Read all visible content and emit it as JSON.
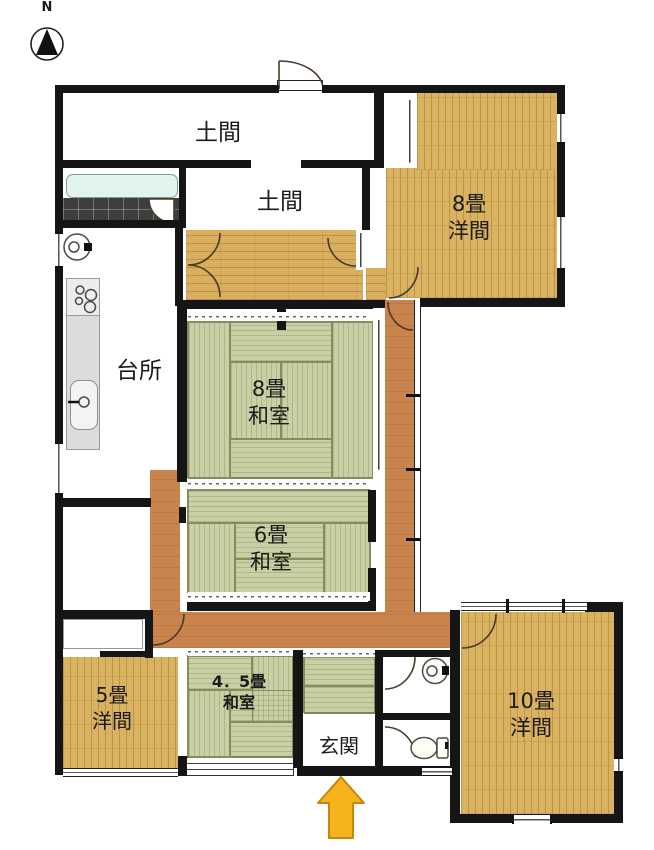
{
  "compass": {
    "label": "N"
  },
  "rooms": {
    "doma_upper": {
      "label": "土間"
    },
    "doma_lower": {
      "label": "土間"
    },
    "kitchen": {
      "label": "台所"
    },
    "western8": {
      "size": "8畳",
      "type": "洋間"
    },
    "japanese8": {
      "size": "8畳",
      "type": "和室"
    },
    "japanese6": {
      "size": "6畳",
      "type": "和室"
    },
    "western5": {
      "size": "5畳",
      "type": "洋間"
    },
    "japanese45": {
      "size": "4．5畳",
      "type": "和室"
    },
    "genkan": {
      "label": "玄関"
    },
    "western10": {
      "size": "10畳",
      "type": "洋間"
    }
  },
  "colors": {
    "wall": "#151515",
    "wood_floor": "#D9B361",
    "hall_floor": "#D9AE5F",
    "corridor_floor": "#C9834C",
    "tatami": "#CBCFA6",
    "tatami_seam": "#878C5F",
    "bathtub": "#E2F4EF",
    "tile_floor": "#3E3E3E",
    "entrance_arrow": "#F5B31C"
  }
}
